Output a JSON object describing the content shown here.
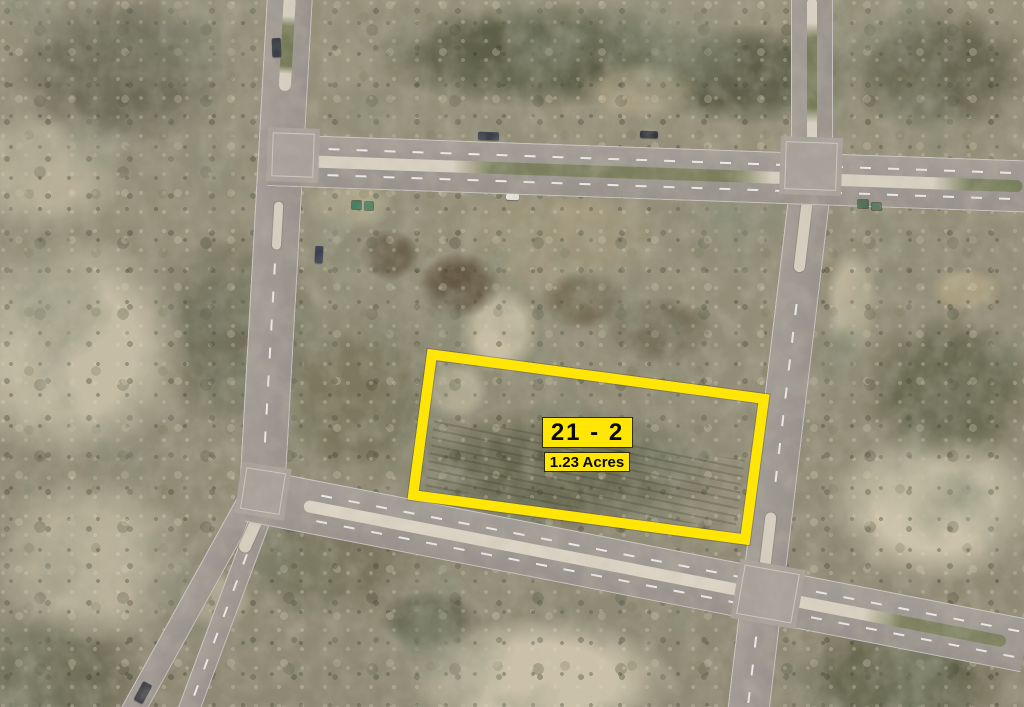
{
  "parcel": {
    "lot_number": "21 - 2",
    "area": "1.23 Acres"
  },
  "annotation_colors": {
    "highlight_yellow": "#ffe606",
    "label_text": "#0a0a0a"
  },
  "scene_colors": {
    "road_asphalt": "#9e9892",
    "median_concrete": "#d8d1c2",
    "median_grass": "#767a58",
    "intersection": "#a7a19a",
    "terrain_sand": "#cec2a8",
    "terrain_olive": "#8f8a73",
    "terrain_dark_green": "#4c5038",
    "vehicle_dark": "#343841"
  }
}
